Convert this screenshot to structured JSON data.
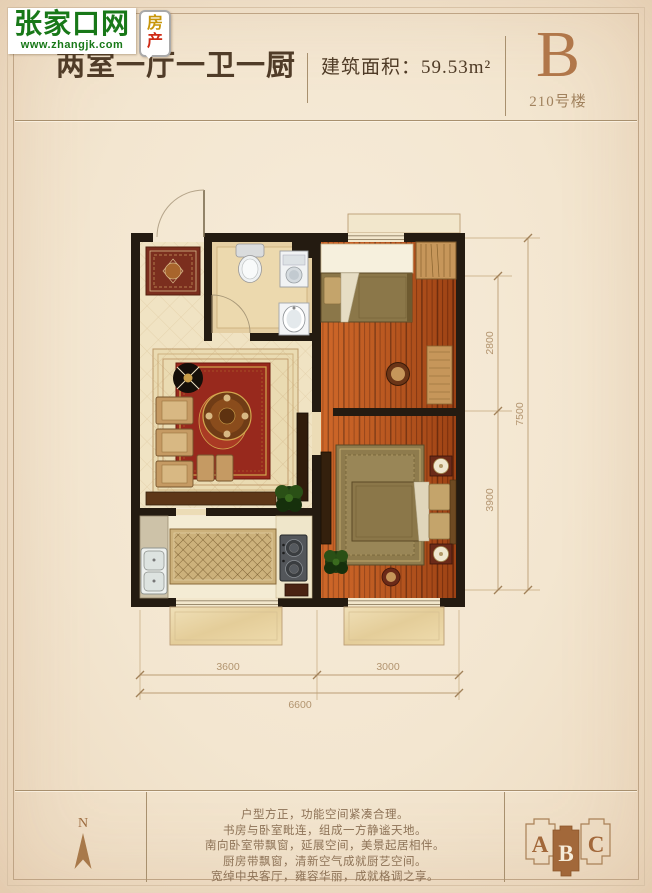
{
  "logo": {
    "site_name": "张家口网",
    "site_url": "www.zhangjk.com",
    "badge_chars": [
      "房",
      "产"
    ]
  },
  "header": {
    "title": "两室一厅一卫一厨",
    "area_label": "建筑面积：",
    "area_value": "59.53m²",
    "unit_letter": "B",
    "building_label": "210号楼"
  },
  "dimensions": {
    "right_upper": "2800",
    "right_lower": "3900",
    "right_total": "7500",
    "bottom_left": "3600",
    "bottom_right": "3000",
    "bottom_total": "6600"
  },
  "compass": {
    "north_label": "N"
  },
  "description": {
    "lines": [
      "户型方正，功能空间紧凑合理。",
      "书房与卧室毗连，组成一方静谧天地。",
      "南向卧室带飘窗，延展空间，美景起居相伴。",
      "厨房带飘窗，清新空气成就厨艺空间。",
      "宽绰中央客厅，雍容华丽，成就格调之享。"
    ]
  },
  "site_plan": {
    "block_a": "A",
    "block_b": "B",
    "block_c": "C",
    "active_block": "B"
  },
  "colors": {
    "accent_brown": "#a2683a",
    "wall_black": "#241b11",
    "wood_orange": "#c2551b",
    "dim_text": "#b2946f",
    "logo_green": "#187818"
  }
}
